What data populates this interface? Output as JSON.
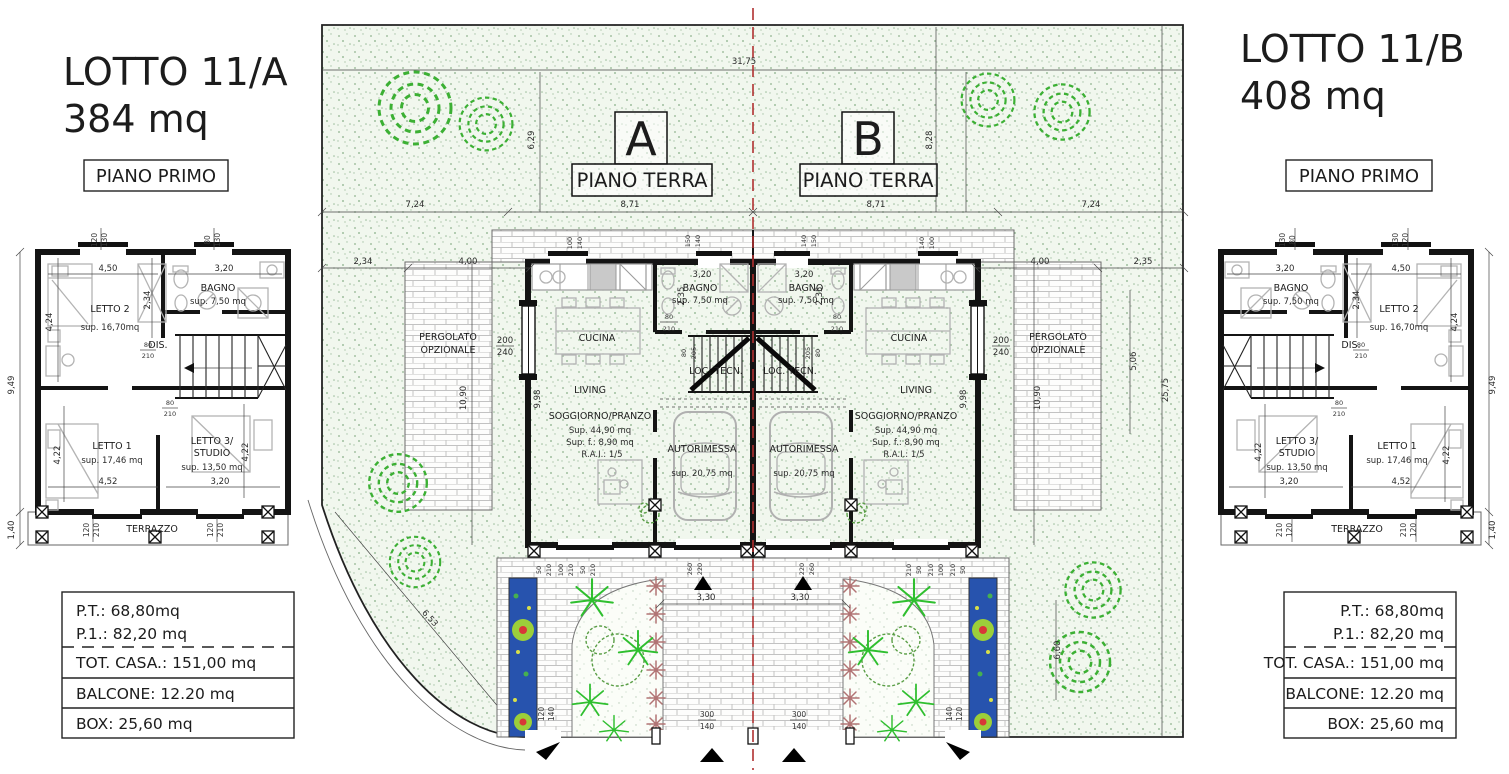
{
  "lot_a": {
    "title": "LOTTO 11/A",
    "area": "384 mq",
    "floor": "PIANO PRIMO"
  },
  "lot_b": {
    "title": "LOTTO 11/B",
    "area": "408 mq",
    "floor": "PIANO PRIMO"
  },
  "summary": {
    "pt": "P.T.: 68,80mq",
    "p1": "P.1.: 82,20 mq",
    "tot": "TOT. CASA.: 151,00 mq",
    "balcone": "BALCONE: 12.20 mq",
    "box": "BOX: 25,60 mq"
  },
  "site": {
    "unit_a": "A",
    "unit_b": "B",
    "piano_terra": "PIANO TERRA",
    "pergolato1": "PERGOLATO",
    "pergolato2": "OPZIONALE",
    "dim": {
      "total": "31,75",
      "a1": "7,24",
      "a2": "8,71",
      "b2": "8,71",
      "b1": "7,24",
      "left_v": "6,29",
      "right_v": "8,28",
      "la": "2,34",
      "lb": "4,00",
      "ra": "4,00",
      "rb": "2,35",
      "perg_l": "10,90",
      "perg_r": "10,90",
      "right_side": "25,75",
      "right_in": "5,06",
      "diag": "6,53",
      "right_low": "6,60",
      "drive_a": "3,30",
      "drive_b": "3,30"
    },
    "gate": {
      "w": "300",
      "h": "140"
    },
    "side_gate": {
      "w": "120",
      "h": "140"
    }
  },
  "unit": {
    "cucina": "CUCINA",
    "living": "LIVING",
    "loc_tecn": "LOC. TECN.",
    "bagno": "BAGNO",
    "bagno_area": "sup. 7,50 mq",
    "bagno_w": "3,20",
    "bagno_h": "2,35",
    "sogg": "SOGGIORNO/PRANZO",
    "sogg_area": "Sup. 44,90 mq",
    "sogg_f": "Sup. f.: 8,90 mq",
    "sogg_rai": "R.A.I.: 1/5",
    "box": "AUTORIMESSA",
    "box_area": "sup. 20,75 mq",
    "depth": "9,98",
    "door1w": "80",
    "door1h": "210",
    "door2w": "80",
    "door2h": "205",
    "win_side_w": "200",
    "win_side_h": "240",
    "wk1w": "100",
    "wk1h": "140",
    "wk2w": "150",
    "wk2h": "140",
    "o1w": "50",
    "o1h": "210",
    "o2w": "100",
    "o2h": "210",
    "o3w": "50",
    "o3h": "210",
    "o4w": "260",
    "o4h": "220"
  },
  "floor1": {
    "letto2": "LETTO 2",
    "letto2_area": "sup. 16,70mq",
    "letto2_w": "4,50",
    "letto2_h1": "2,34",
    "letto2_h2": "4,24",
    "bagno": "BAGNO",
    "bagno_area": "sup. 7,50 mq",
    "bagno_w": "3,20",
    "dis": "DIS.",
    "door_w": "80",
    "door_h": "210",
    "letto1": "LETTO 1",
    "letto1_area": "sup. 17,46 mq",
    "letto1_w": "4,52",
    "letto1_h": "4,22",
    "letto3a": "LETTO 3/",
    "letto3b": "STUDIO",
    "letto3_area": "sup. 13,50 mq",
    "letto3_w": "3,20",
    "letto3_h": "4,22",
    "terrazzo": "TERRAZZO",
    "total_h": "9,49",
    "terr_d": "1,40",
    "w1a": "120",
    "w1b": "130",
    "w2a": "80",
    "w2b": "130",
    "w3a": "120",
    "w3b": "210"
  }
}
